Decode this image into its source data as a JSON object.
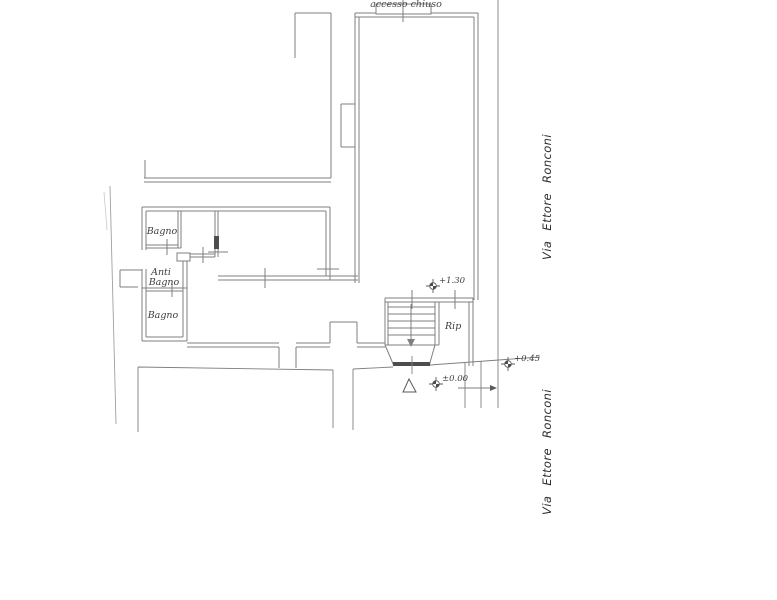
{
  "plan": {
    "labels": {
      "access_note": "accesso chiuso",
      "room_bagno_upper": "Bagno",
      "room_anti_bagno_line1": "Anti",
      "room_anti_bagno_line2": "Bagno",
      "room_bagno_lower": "Bagno",
      "room_rip": "Rip"
    },
    "street": {
      "name_upper": "Via Ettore Ronconi",
      "name_lower": "Via Ettore Ronconi"
    },
    "elevations": {
      "stair_landing": "+1.30",
      "entrance_threshold": "±0.00",
      "sidewalk": "+0.45"
    },
    "colors": {
      "wall": "#7f7f7f",
      "boundary": "#a0a0a0",
      "faint": "#c9c9c9",
      "dark_fill": "#4d4d4d",
      "marker": "#5a5a5a",
      "text": "#3d3d3d"
    }
  }
}
